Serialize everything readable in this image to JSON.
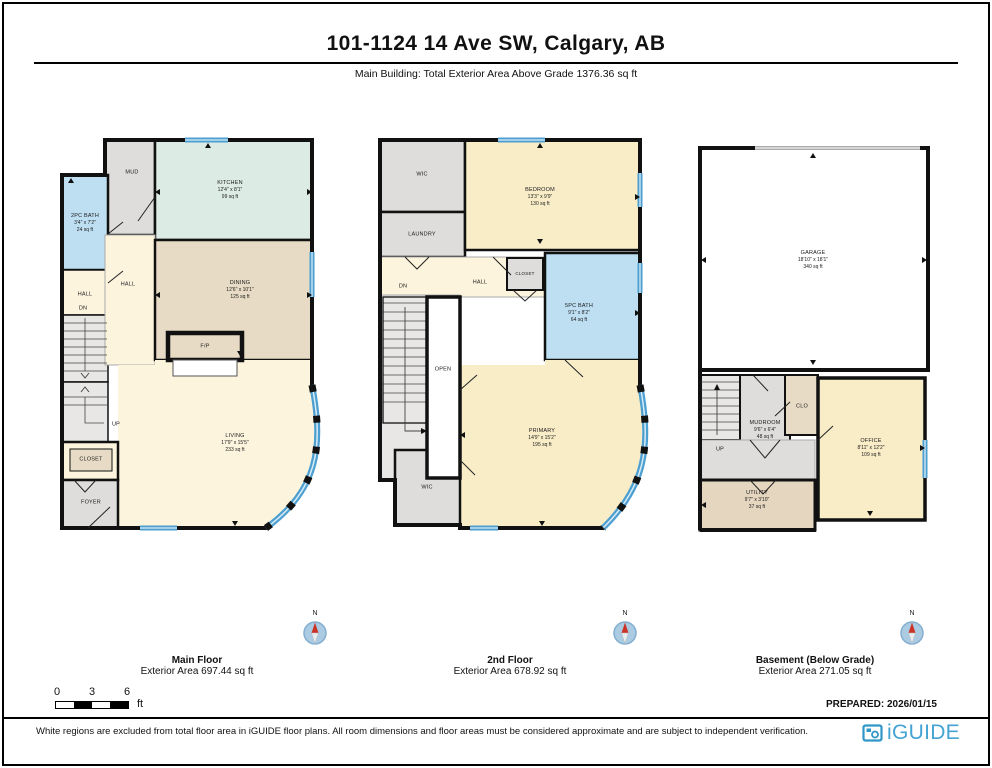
{
  "header": {
    "title": "101-1124 14 Ave SW, Calgary, AB",
    "subtitle": "Main Building: Total Exterior Area Above Grade 1376.36 sq ft"
  },
  "floors": {
    "main": {
      "name": "Main Floor",
      "area": "Exterior Area 697.44 sq ft",
      "rooms": {
        "mud": {
          "name": "MUD"
        },
        "kitchen": {
          "name": "KITCHEN",
          "dims": "12'4\" x 8'1\"",
          "area": "99 sq ft"
        },
        "bath2pc": {
          "name": "2PC BATH",
          "dims": "3'4\" x 7'2\"",
          "area": "24 sq ft"
        },
        "hall_left": {
          "name": "HALL"
        },
        "dn": {
          "name": "DN"
        },
        "hall": {
          "name": "HALL"
        },
        "dining": {
          "name": "DINING",
          "dims": "12'6\" x 10'1\"",
          "area": "125 sq ft"
        },
        "fp": {
          "name": "F/P"
        },
        "living": {
          "name": "LIVING",
          "dims": "17'9\" x 15'5\"",
          "area": "233 sq ft"
        },
        "up": {
          "name": "UP"
        },
        "closet": {
          "name": "CLOSET"
        },
        "foyer": {
          "name": "FOYER"
        }
      }
    },
    "second": {
      "name": "2nd Floor",
      "area": "Exterior Area 678.92 sq ft",
      "rooms": {
        "wic_top": {
          "name": "WIC"
        },
        "bedroom": {
          "name": "BEDROOM",
          "dims": "13'3\" x 9'9\"",
          "area": "130 sq ft"
        },
        "laundry": {
          "name": "LAUNDRY"
        },
        "dn": {
          "name": "DN"
        },
        "hall": {
          "name": "HALL"
        },
        "closet": {
          "name": "CLOSET"
        },
        "bath5pc": {
          "name": "5PC BATH",
          "dims": "9'1\" x 8'2\"",
          "area": "64 sq ft"
        },
        "open": {
          "name": "OPEN"
        },
        "wic_bottom": {
          "name": "WIC"
        },
        "primary": {
          "name": "PRIMARY",
          "dims": "14'9\" x 15'2\"",
          "area": "195 sq ft"
        }
      }
    },
    "basement": {
      "name": "Basement (Below Grade)",
      "area": "Exterior Area 271.05 sq ft",
      "rooms": {
        "garage": {
          "name": "GARAGE",
          "dims": "18'10\" x 18'1\"",
          "area": "340 sq ft"
        },
        "up": {
          "name": "UP"
        },
        "mudroom": {
          "name": "MUDROOM",
          "dims": "9'6\" x 6'4\"",
          "area": "48 sq ft"
        },
        "clo": {
          "name": "CLO"
        },
        "office": {
          "name": "OFFICE",
          "dims": "8'11\" x 12'2\"",
          "area": "109 sq ft"
        },
        "utility": {
          "name": "UTILITY",
          "dims": "9'7\" x 3'10\"",
          "area": "37 sq ft"
        }
      }
    }
  },
  "compass": {
    "north": "N"
  },
  "scale_bar": {
    "t0": "0",
    "t3": "3",
    "t6": "6",
    "unit": "ft"
  },
  "footer": {
    "prepared": "PREPARED: 2026/01/15",
    "disclaimer": "White regions are excluded from total floor area in iGUIDE floor plans. All room dimensions and floor areas must be considered approximate and are subject to independent verification.",
    "brand": "iGUIDE"
  },
  "colors": {
    "wall": "#111111",
    "window_blue": "#4d9fcf",
    "room_cream": "#fdf4de",
    "room_yellow": "#f9edc8",
    "room_tan": "#e7dbc5",
    "room_green": "#dcebe3",
    "room_bath_blue": "#bedff2",
    "room_gray": "#dedddb",
    "brand_blue": "#44a3d3",
    "compass_blue": "#aacbe2",
    "needle_red": "#cc3327"
  }
}
